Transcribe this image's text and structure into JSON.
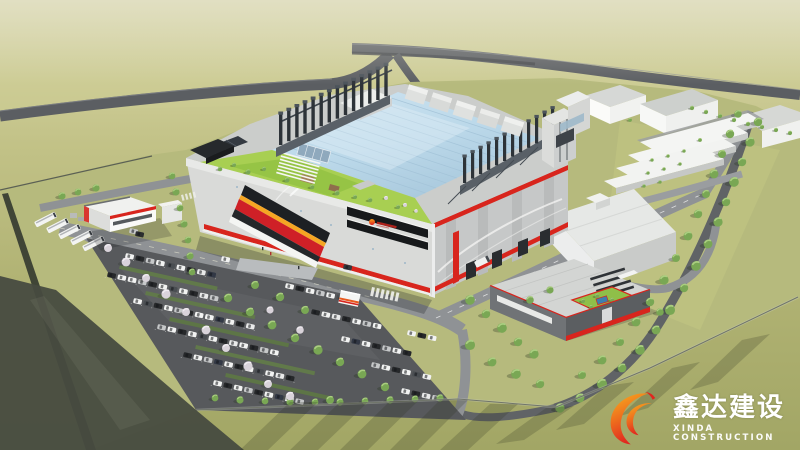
{
  "watermark": {
    "company_name_cn": "鑫达建设",
    "company_name_en": "XINDA CONSTRUCTION"
  },
  "brand": {
    "accent_red": "#d8251d",
    "accent_orange": "#f5a21c",
    "flame_gradient": [
      "#f8b020",
      "#ee6f1d",
      "#e0261f"
    ],
    "glass_roof_blue": "#bcd9ea",
    "rooftop_garden_green": "#a8cf52",
    "grass_olive": "#b2b474",
    "text_white": "#ffffff"
  },
  "icons": {
    "watermark_logo": "flame-swirl-icon",
    "facade_logo": "flame-mark-icon"
  },
  "scene": {
    "description": "Aerial architectural rendering of an industrial campus: main factory with blue glass roof, rooftop garden and chimney rows, white warehouses, red-trimmed auxiliary building, tree-lined roads, car park with buses"
  }
}
